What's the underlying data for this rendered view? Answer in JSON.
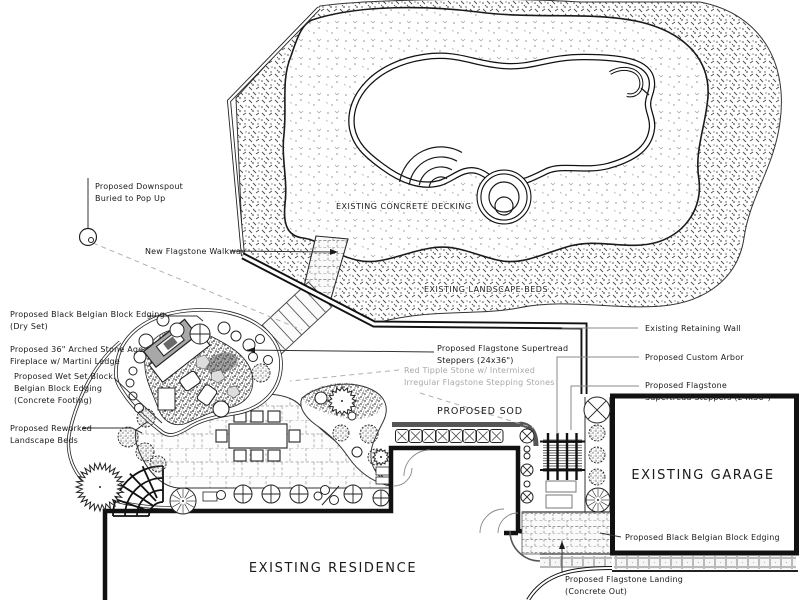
{
  "drawing": {
    "type": "landscape-architecture-plan",
    "colors": {
      "ink": "#1a1a1a",
      "leader_gray": "#999999",
      "label_gray": "#a9a9a9",
      "edging_dark": "#555555",
      "flagstone_line": "#b3b3b3",
      "paper": "#ffffff"
    },
    "areas": {
      "decking": "EXISTING CONCRETE DECKING",
      "beds": "EXISTING LANDSCAPE BEDS",
      "sod": "PROPOSED SOD",
      "garage": "EXISTING GARAGE",
      "residence": "EXISTING RESIDENCE"
    },
    "callouts": {
      "downspout1": "Proposed Downspout",
      "downspout2": "Buried to Pop Up",
      "walkway": "New Flagstone Walkway",
      "dryset1": "Proposed Black Belgian Block Edging",
      "dryset2": "(Dry Set)",
      "fireplace1": "Proposed 36\" Arched Stone Age",
      "fireplace2": "Fireplace w/ Martini Ledge",
      "wetset1": "Proposed Wet Set Block",
      "wetset2": "Belgian Block Edging",
      "wetset3": "(Concrete Footing)",
      "reworked1": "Proposed Reworked",
      "reworked2": "Landscape Beds",
      "steppersMid1": "Proposed Flagstone Supertread",
      "steppersMid2": "Steppers (24x36\")",
      "tipple1": "Red Tipple Stone w/ Intermixed",
      "tipple2": "Irregular Flagstone Stepping Stones",
      "retainingWall": "Existing Retaining Wall",
      "arbor": "Proposed Custom Arbor",
      "steppersRight1": "Proposed Flagstone",
      "steppersRight2": "Supertread Steppers (24x36\")",
      "edgingRight": "Proposed Black Belgian Block Edging",
      "landing1": "Proposed Flagstone Landing",
      "landing2": "(Concrete Out)"
    }
  }
}
